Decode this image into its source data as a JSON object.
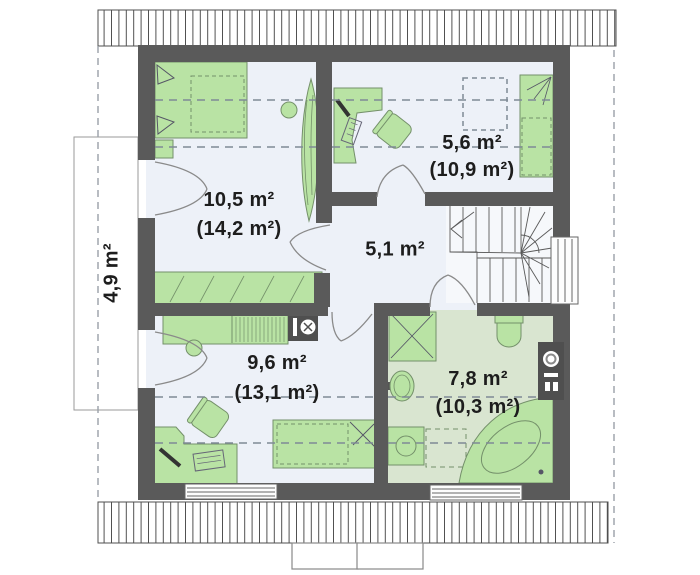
{
  "plan": {
    "type": "attic-floor-plan",
    "colors": {
      "wall": "#5a5a5a",
      "floor": "#edf1f8",
      "bathroom_floor": "#d9e5d0",
      "furniture": "#b9e3a4",
      "furniture_outline": "#74906a",
      "dashed_line": "#7f8a96",
      "text": "#1d1d1d"
    }
  },
  "rooms": [
    {
      "id": "room-105",
      "area": "10,5 m²",
      "area_total": "(14,2 m²)",
      "fixtures": [
        "double-bed",
        "nightstand",
        "stool",
        "wardrobe",
        "plant"
      ]
    },
    {
      "id": "room-56",
      "area": "5,6 m²",
      "area_total": "(10,9 m²)",
      "fixtures": [
        "corner-desk",
        "office-chair",
        "single-bed",
        "skylight"
      ]
    },
    {
      "id": "hall",
      "area": "5,1 m²",
      "fixtures": [
        "winder-staircase",
        "stair-window"
      ]
    },
    {
      "id": "storage",
      "area": "4,9 m²",
      "fixtures": []
    },
    {
      "id": "room-96",
      "area": "9,6 m²",
      "area_total": "(13,1 m²)",
      "fixtures": [
        "cabinet",
        "dresser",
        "stool",
        "office-chair",
        "desk",
        "single-bed",
        "window"
      ]
    },
    {
      "id": "bathroom",
      "area": "7,8 m²",
      "area_total": "(10,3 m²)",
      "fixtures": [
        "shower",
        "toilet",
        "water-heater",
        "sink",
        "washing-machine",
        "corner-bathtub",
        "window"
      ]
    }
  ]
}
